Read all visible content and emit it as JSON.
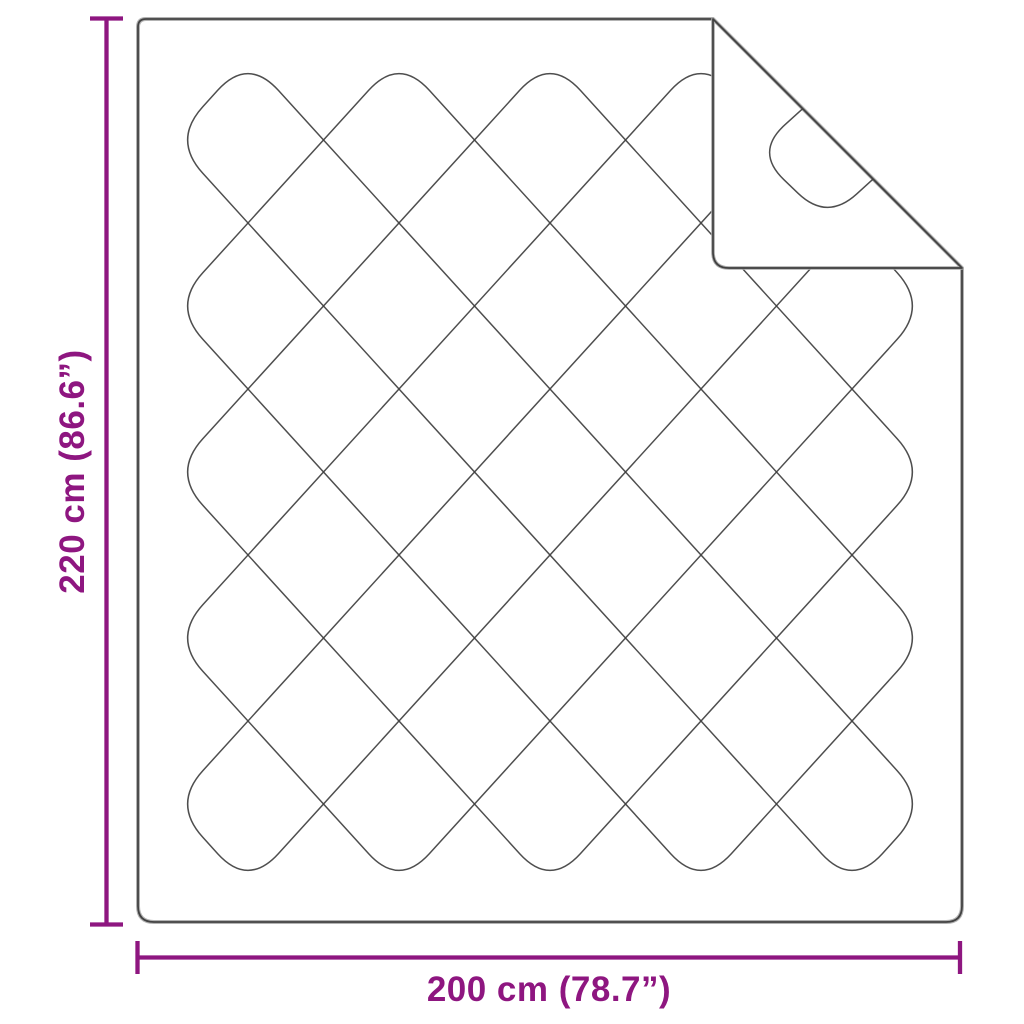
{
  "colors": {
    "accent": "#8e1680"
  },
  "dimensions": {
    "height_label": "220 cm (86.6”)",
    "width_label": "200 cm (78.7”)"
  }
}
